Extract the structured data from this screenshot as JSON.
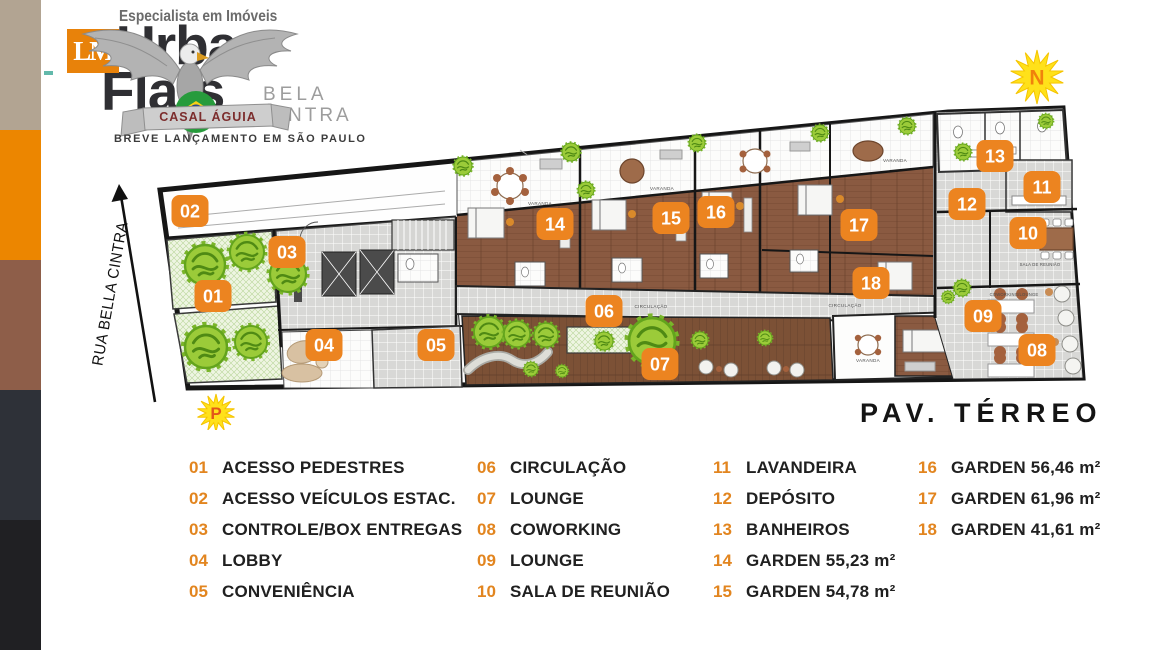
{
  "side_strip": {
    "colors": [
      "#B2A492",
      "#EC8600",
      "#8E5E49",
      "#2E3138",
      "#202023"
    ]
  },
  "brand": {
    "tagline": "Especialista em Imóveis",
    "monogram": "LM",
    "name_line1": "Urban",
    "name_line2": "Flats",
    "subname_line1": "BELA",
    "subname_line2": "CINTRA",
    "ribbon_text": "CASAL ÁGUIA",
    "launch_text": "BREVE LANÇAMENTO EM SÃO PAULO"
  },
  "street": {
    "name": "RUA BELLA CINTRA"
  },
  "compass": {
    "north_label": "N",
    "sun_label": "P"
  },
  "floor_title": "PAV. TÉRREO",
  "plan_labels": {
    "varanda": "VARANDA",
    "circulacao": "CIRCULAÇÃO",
    "sala_reuniao": "SALA DE REUNIÃO",
    "coworking_lounge": "COWORKING/LOUNGE"
  },
  "plan_badges": [
    {
      "num": "01",
      "x": 213,
      "y": 296
    },
    {
      "num": "02",
      "x": 190,
      "y": 211
    },
    {
      "num": "03",
      "x": 287,
      "y": 252
    },
    {
      "num": "04",
      "x": 324,
      "y": 345
    },
    {
      "num": "05",
      "x": 436,
      "y": 345
    },
    {
      "num": "06",
      "x": 604,
      "y": 311
    },
    {
      "num": "07",
      "x": 660,
      "y": 364
    },
    {
      "num": "08",
      "x": 1037,
      "y": 350
    },
    {
      "num": "09",
      "x": 983,
      "y": 316
    },
    {
      "num": "10",
      "x": 1028,
      "y": 233
    },
    {
      "num": "11",
      "x": 1042,
      "y": 187
    },
    {
      "num": "12",
      "x": 967,
      "y": 204
    },
    {
      "num": "13",
      "x": 995,
      "y": 156
    },
    {
      "num": "14",
      "x": 555,
      "y": 224
    },
    {
      "num": "15",
      "x": 671,
      "y": 218
    },
    {
      "num": "16",
      "x": 716,
      "y": 212
    },
    {
      "num": "17",
      "x": 859,
      "y": 225
    },
    {
      "num": "18",
      "x": 871,
      "y": 283
    }
  ],
  "legend": {
    "columns": [
      {
        "items": [
          {
            "num": "01",
            "label": "ACESSO PEDESTRES"
          },
          {
            "num": "02",
            "label": "ACESSO VEÍCULOS ESTAC."
          },
          {
            "num": "03",
            "label": "CONTROLE/BOX ENTREGAS"
          },
          {
            "num": "04",
            "label": "LOBBY"
          },
          {
            "num": "05",
            "label": "CONVENIÊNCIA"
          }
        ]
      },
      {
        "items": [
          {
            "num": "06",
            "label": "CIRCULAÇÃO"
          },
          {
            "num": "07",
            "label": "LOUNGE"
          },
          {
            "num": "08",
            "label": "COWORKING"
          },
          {
            "num": "09",
            "label": "LOUNGE"
          },
          {
            "num": "10",
            "label": "SALA DE REUNIÃO"
          }
        ]
      },
      {
        "items": [
          {
            "num": "11",
            "label": "LAVANDEIRA"
          },
          {
            "num": "12",
            "label": "DEPÓSITO"
          },
          {
            "num": "13",
            "label": "BANHEIROS"
          },
          {
            "num": "14",
            "label": "GARDEN 55,23 m²"
          },
          {
            "num": "15",
            "label": "GARDEN 54,78 m²"
          }
        ]
      },
      {
        "items": [
          {
            "num": "16",
            "label": "GARDEN 56,46 m²"
          },
          {
            "num": "17",
            "label": "GARDEN 61,96 m²"
          },
          {
            "num": "18",
            "label": "GARDEN 41,61 m²"
          }
        ]
      }
    ]
  },
  "palette": {
    "badge_orange": "#EC8420",
    "legend_number_orange": "#E2851F",
    "text_dark": "#1F1F1F",
    "wall_black": "#161616",
    "wood_brown": "#8A5A41",
    "deck_brown": "#7C5136",
    "tile_gray": "#D8D8D6",
    "tree_green": "#9BCB39",
    "tree_dark_green": "#4F8A14",
    "sun_yellow": "#FFE11A",
    "compass_letter_orange": "#F0820C"
  }
}
